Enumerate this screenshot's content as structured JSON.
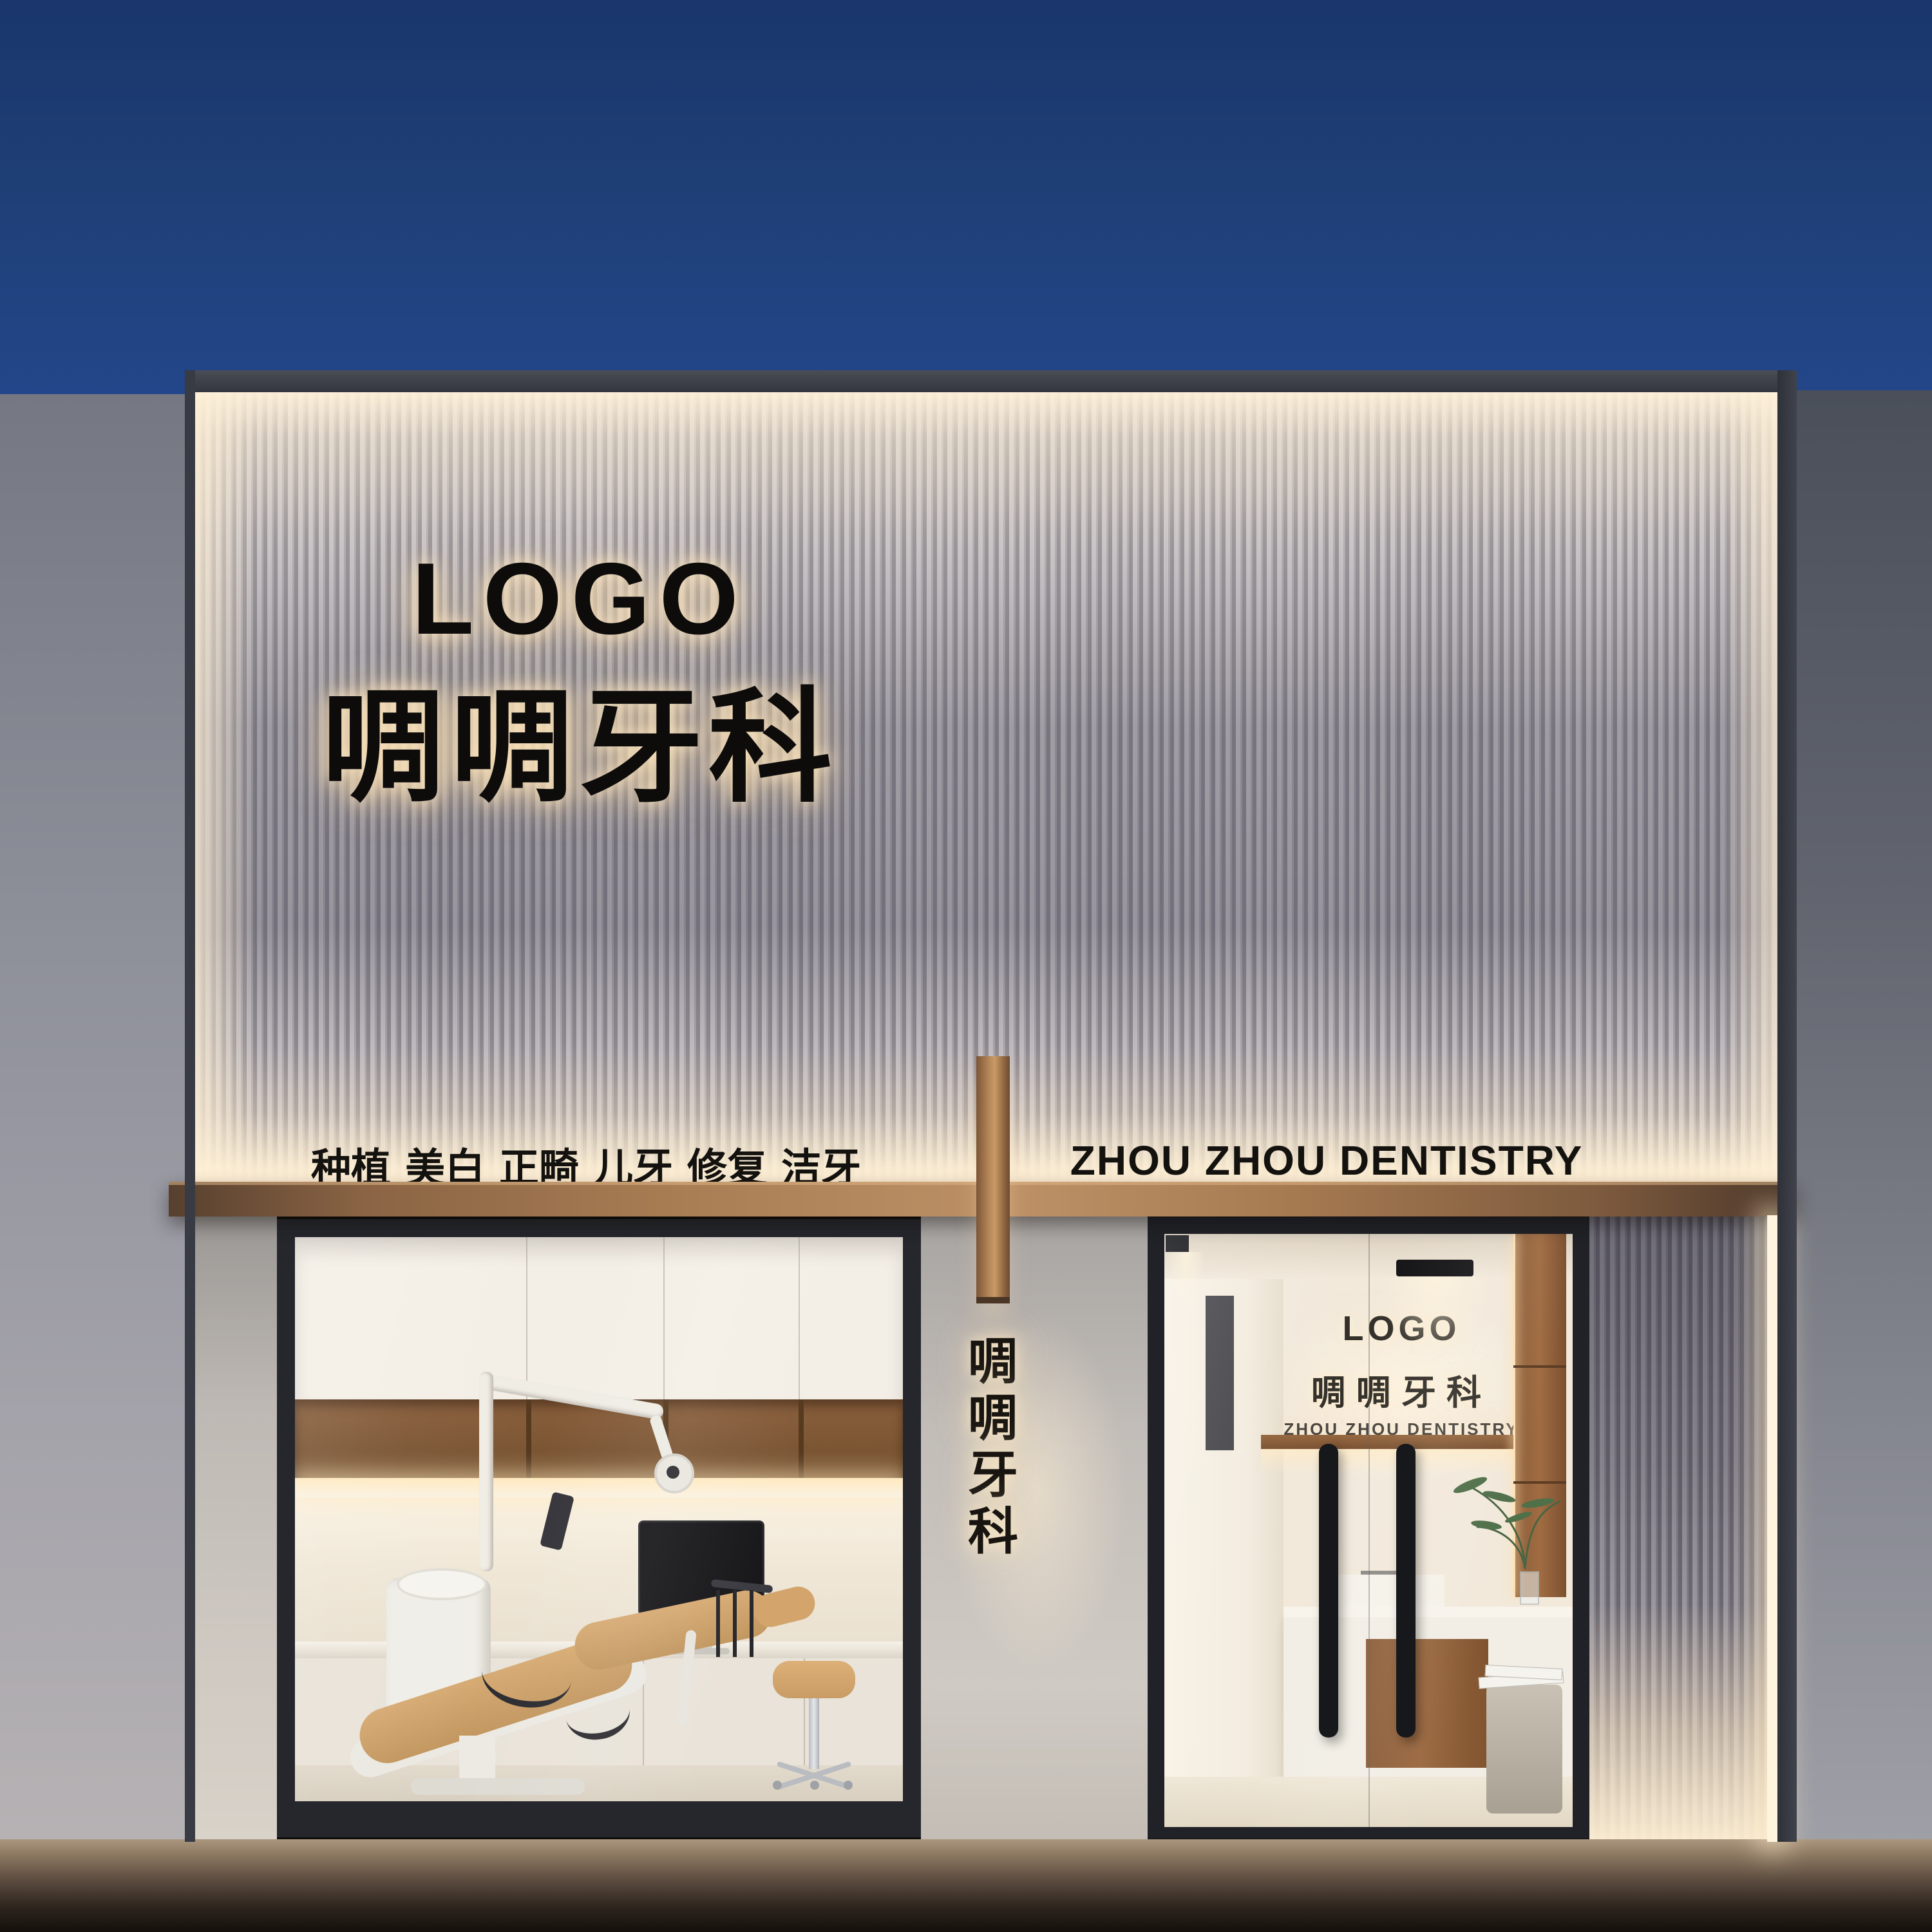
{
  "scene": {
    "description": "Night-time 3D render of a dental clinic storefront with backlit slatted facade",
    "colors": {
      "sky_blue": "#1f4078",
      "canopy_bronze": "#a87c52",
      "wood_brown": "#8a5c38",
      "warm_glow": "#ffeccb",
      "frame_dark": "#25272d",
      "slat_light": "#c4c0c5",
      "slat_dark": "#8e8a92"
    }
  },
  "signs": {
    "main": {
      "logo": "LOGO",
      "name_cn": "啁啁牙科"
    },
    "services": [
      "种植",
      "美白",
      "正畸",
      "儿牙",
      "修复",
      "洁牙"
    ],
    "name_en": "ZHOU ZHOU DENTISTRY",
    "vertical": [
      "啁",
      "啁",
      "牙",
      "科"
    ],
    "interior": {
      "logo": "LOGO",
      "name_cn": "啁啁牙科",
      "name_en": "ZHOU ZHOU DENTISTRY"
    }
  }
}
